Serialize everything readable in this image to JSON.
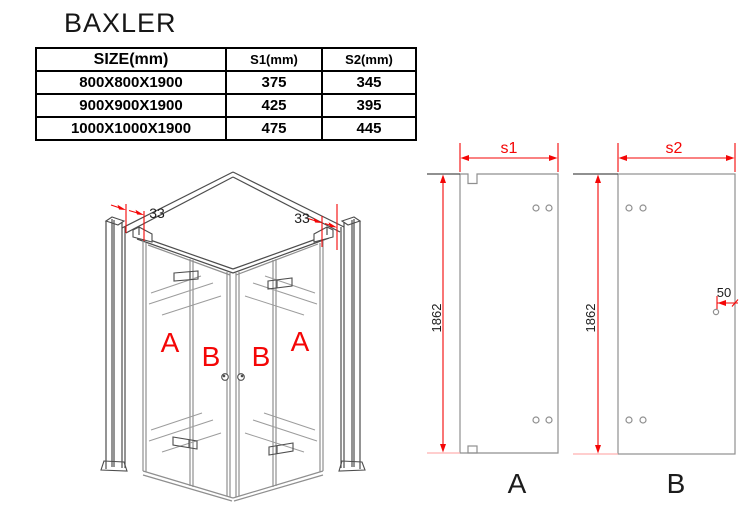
{
  "title": "BAXLER",
  "size_table": {
    "headers": [
      "SIZE(mm)",
      "S1(mm)",
      "S2(mm)"
    ],
    "rows": [
      [
        "800X800X1900",
        "375",
        "345"
      ],
      [
        "900X900X1900",
        "425",
        "395"
      ],
      [
        "1000X1000X1900",
        "475",
        "445"
      ]
    ]
  },
  "iso": {
    "dim_left_mm": "33",
    "dim_right_mm": "33",
    "labels": {
      "left_outer": "A",
      "left_inner": "B",
      "right_inner": "B",
      "right_outer": "A"
    }
  },
  "panel_a": {
    "width": "s1",
    "height": "1862",
    "label": "A"
  },
  "panel_b": {
    "width": "s2",
    "height": "1862",
    "hole_offset": "50",
    "label": "B"
  },
  "colors": {
    "dimension_red": "#f40606",
    "drawing_gray": "#8f8f8f",
    "frame_dark": "#4d4d4d",
    "extension_pink": "#ffb0b0",
    "table_black": "#000000"
  }
}
